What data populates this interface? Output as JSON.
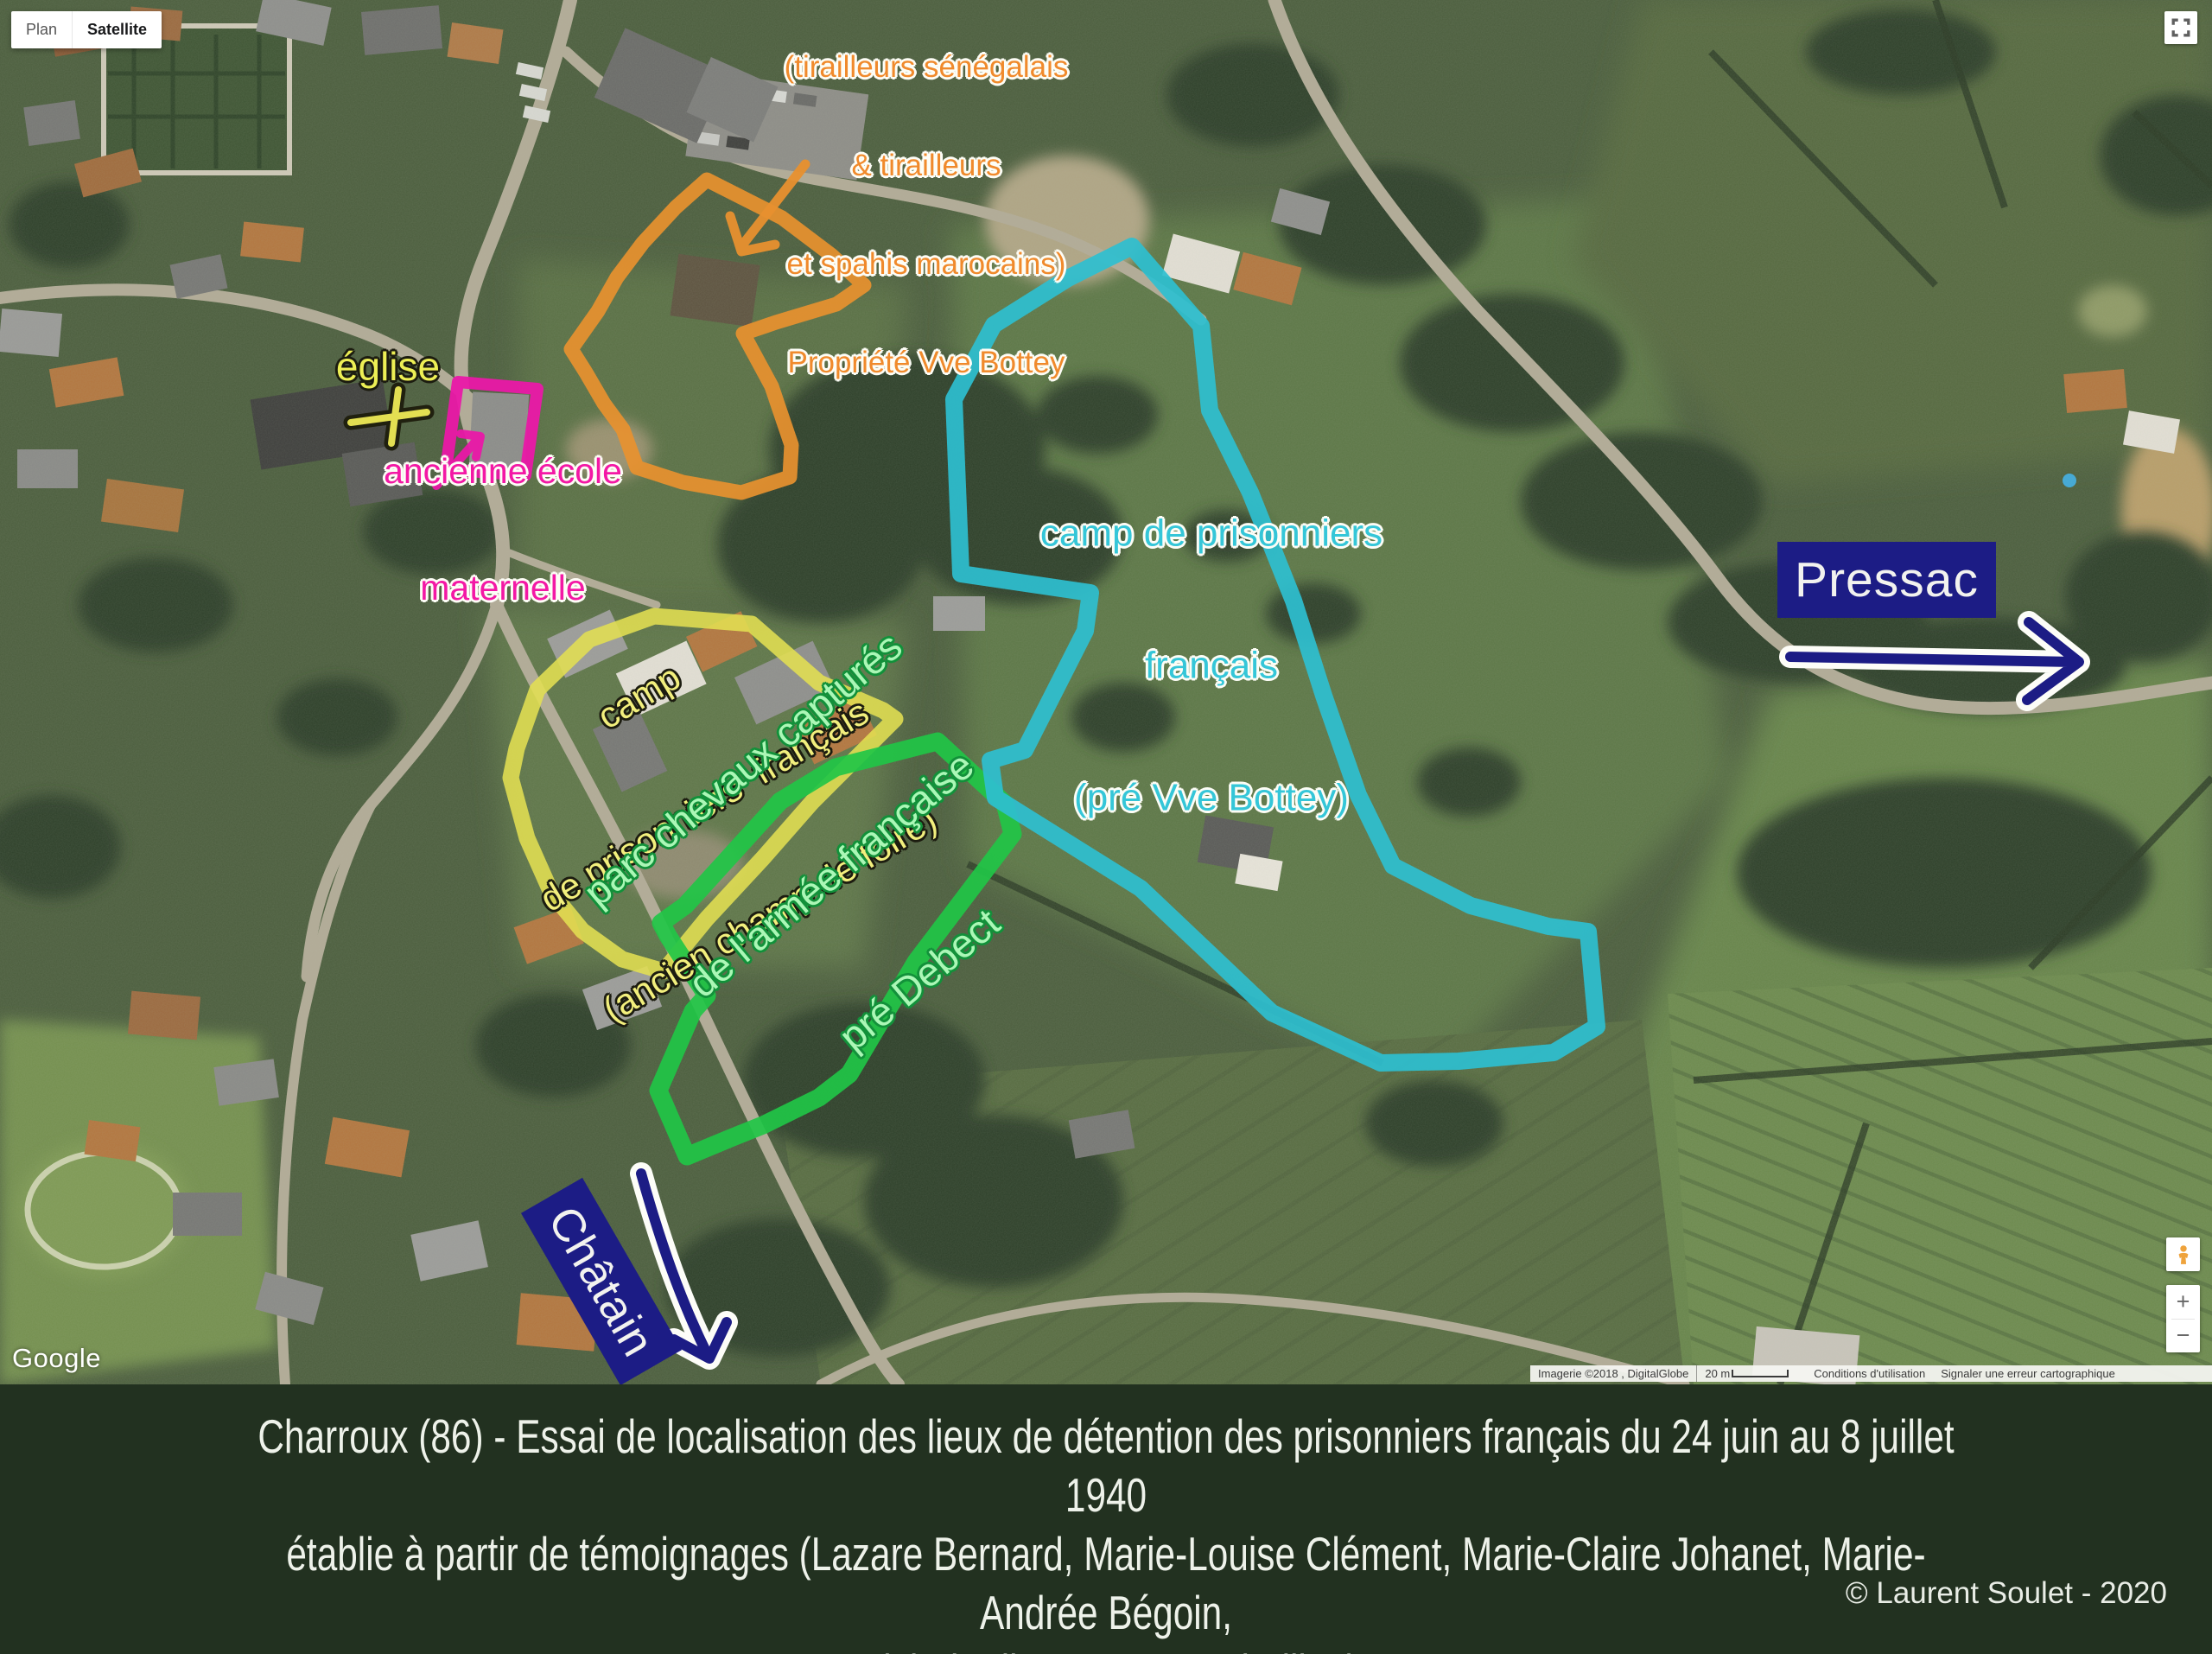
{
  "map": {
    "controls": {
      "plan_label": "Plan",
      "satellite_label": "Satellite",
      "zoom_in_label": "+",
      "zoom_out_label": "−",
      "google_logo": "Google",
      "fullscreen_icon": "fullscreen-corners-icon",
      "pegman_icon": "pegman-icon"
    },
    "attribution": {
      "imagery": "Imagerie ©2018 , DigitalGlobe",
      "scale_label": "20 m",
      "terms_label": "Conditions d'utilisation",
      "report_label": "Signaler une erreur cartographique"
    }
  },
  "annotations": {
    "church": {
      "label": "église"
    },
    "school": {
      "line1": "ancienne école",
      "line2": "maternelle"
    },
    "orange_camp": {
      "line1": "camp prisonniers français",
      "line2": "(tirailleurs sénégalais",
      "line3": "& tirailleurs",
      "line4": "et spahis marocains)",
      "line5": "Propriété Vve Bottey"
    },
    "yellow_camp": {
      "line1": "camp",
      "line2": "de prisonniers  français",
      "line3": "(ancien champ de foire)"
    },
    "green_camp": {
      "line1": "parc chevaux capturés",
      "line2": "de l'armée française",
      "line3": "pré Debect"
    },
    "cyan_camp": {
      "line1": "camp de prisonniers",
      "line2": "français",
      "line3": "(pré Vve Bottey)"
    },
    "direction_pressac": {
      "label": "Pressac"
    },
    "direction_chatain": {
      "label": "Châtain"
    },
    "colors": {
      "orange": "#e8912f",
      "magenta": "#ea18a8",
      "yellow": "#e3df52",
      "green": "#21c546",
      "cyan": "#2ebfd0",
      "navy": "#1c1c85"
    }
  },
  "caption": {
    "line1": "Charroux (86) - Essai de localisation des lieux de détention des prisonniers français du 24 juin au 8 juillet 1940",
    "line2": "établie à partir de témoignages (Lazare Bernard, Marie-Louise Clément, Marie-Claire Johanet, Marie-Andrée Bégoin,",
    "line3": "Michel Tribert, Raymond Fillon)",
    "copyright": "© Laurent Soulet - 2020"
  }
}
